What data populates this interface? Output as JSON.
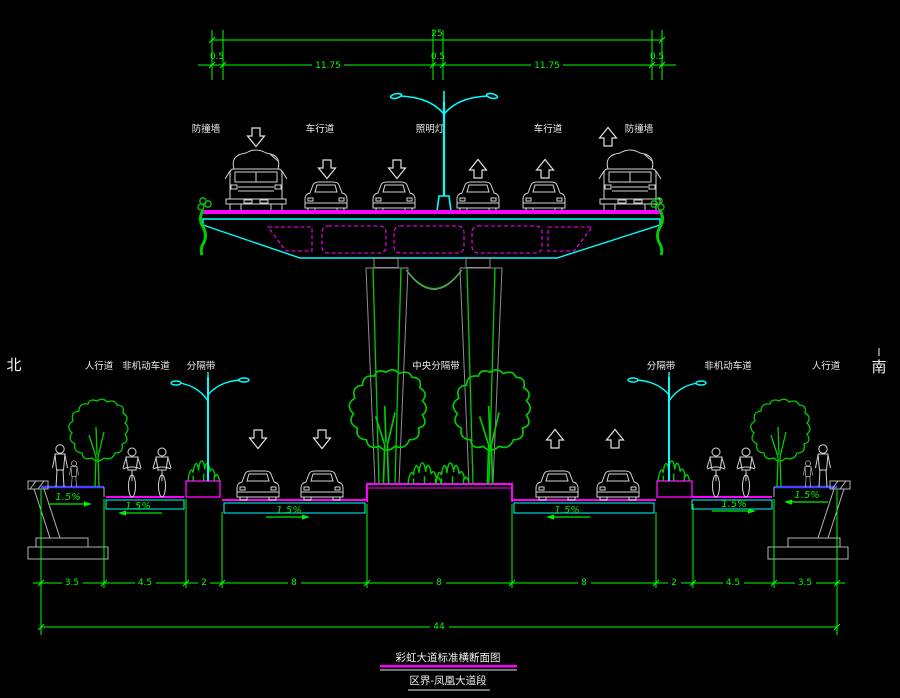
{
  "colors": {
    "background": "#000000",
    "dimension_green": "#00ff00",
    "deck_magenta": "#ff00ff",
    "girder_cyan": "#00ffff",
    "sidewalk_blue": "#4343ff",
    "vehicle_gray": "#d4d4d4",
    "vegetation_green": "#00cc00"
  },
  "compass": {
    "north": "北",
    "south": "南"
  },
  "deck_labels": [
    "防撞墙",
    "车行道",
    "照明灯",
    "车行道",
    "防撞墙"
  ],
  "road_labels": [
    "人行道",
    "非机动车道",
    "分隔带",
    "中央分隔带",
    "分隔带",
    "非机动车道",
    "人行道"
  ],
  "dims_top": {
    "total": "25",
    "segments": [
      "0.5",
      "11.75",
      "0.5",
      "11.75",
      "0.5"
    ]
  },
  "dims_bottom": {
    "segments": [
      "3.5",
      "4.5",
      "2",
      "8",
      "8",
      "8",
      "2",
      "4.5",
      "3.5"
    ],
    "total": "44"
  },
  "slope_label": "1.5%",
  "title": {
    "line1": "彩虹大道标准横断面图",
    "line2": "区界-凤凰大道段"
  }
}
